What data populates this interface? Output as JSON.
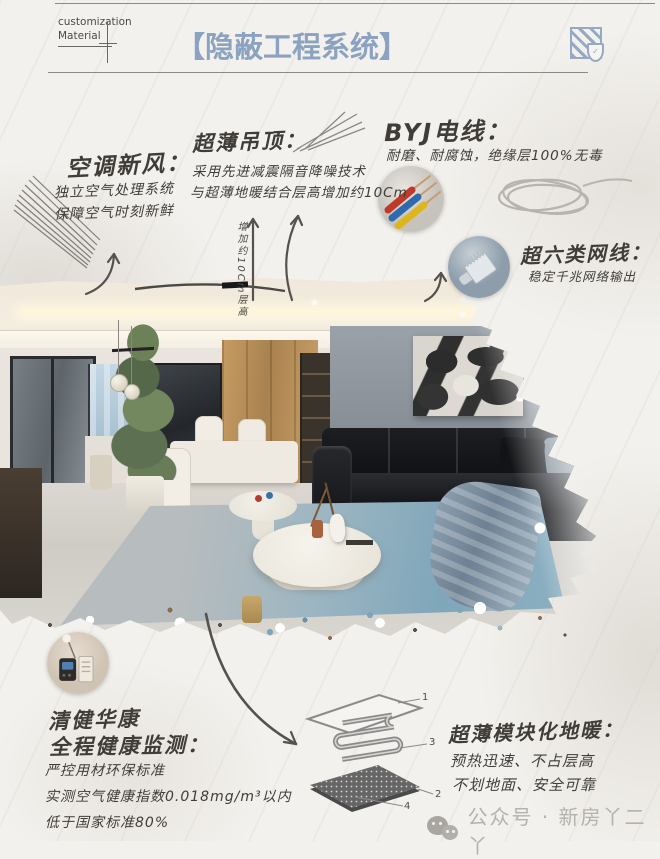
{
  "header": {
    "brand": {
      "line1": "customization",
      "line2": "Material"
    },
    "title": "【隐蔽工程系统】"
  },
  "sections": {
    "hvac": {
      "title": "空调新风：",
      "line1": "独立空气处理系统",
      "line2": "保障空气时刻新鲜"
    },
    "ceiling": {
      "title": "超薄吊顶：",
      "line1": "采用先进减震隔音降噪技术",
      "line2": "与超薄地暖结合层高增加约10Cm",
      "dim_note": "增加约10Cm层高"
    },
    "wire": {
      "title": "BYJ电线：",
      "line1": "耐磨、耐腐蚀，绝缘层100%无毒"
    },
    "network": {
      "title": "超六类网线：",
      "line1": "稳定千兆网络输出"
    },
    "health": {
      "title1": "清健华康",
      "title2": "全程健康监测：",
      "line1": "严控用材环保标准",
      "line2": "实测空气健康指数0.018mg/m³以内",
      "line3": "低于国家标准80%"
    },
    "heating": {
      "title": "超薄模块化地暖：",
      "line1": "预热迅速、不占层高",
      "line2": "不划地面、安全可靠",
      "labels": {
        "l1": "1",
        "l2": "3",
        "l3": "2",
        "l4": "4"
      }
    }
  },
  "watermark": {
    "text": "公众号 · 新房丫二丫"
  },
  "colors": {
    "accent": "#8ba2c0"
  }
}
